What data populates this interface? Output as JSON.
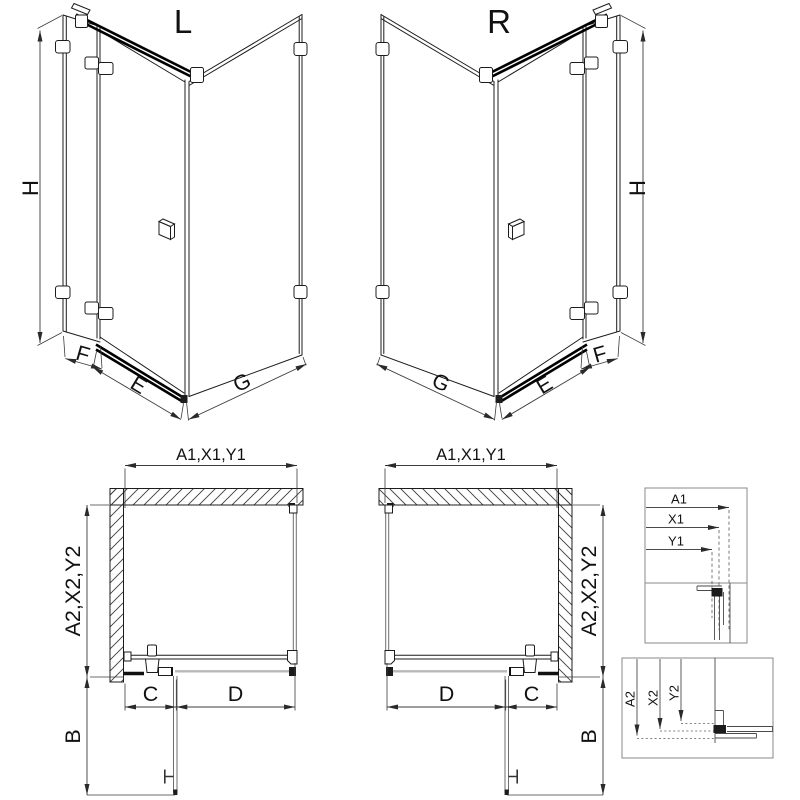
{
  "iso_left": {
    "variant": "L",
    "height_dim": "H",
    "fixed_panel_dim": "F",
    "door_dim": "E",
    "side_panel_dim": "G"
  },
  "iso_right": {
    "variant": "R",
    "height_dim": "H",
    "fixed_panel_dim": "F",
    "door_dim": "E",
    "side_panel_dim": "G"
  },
  "plan_left": {
    "width_dim": "A1,X1,Y1",
    "depth_dim": "A2,X2,Y2",
    "hinge_segment_dim": "C",
    "door_segment_dim": "D",
    "swing_dim": "B"
  },
  "plan_right": {
    "width_dim": "A1,X1,Y1",
    "depth_dim": "A2,X2,Y2",
    "hinge_segment_dim": "C",
    "door_segment_dim": "D",
    "swing_dim": "B"
  },
  "detail_width": {
    "labels": [
      "A1",
      "X1",
      "Y1"
    ]
  },
  "detail_depth": {
    "labels": [
      "A2",
      "X2",
      "Y2"
    ]
  },
  "colors": {
    "line": "#1c1c1c",
    "dimension": "#3c3c3c",
    "sill": "#b8b8b8",
    "box_border": "#8a8a8a",
    "background": "#ffffff"
  }
}
